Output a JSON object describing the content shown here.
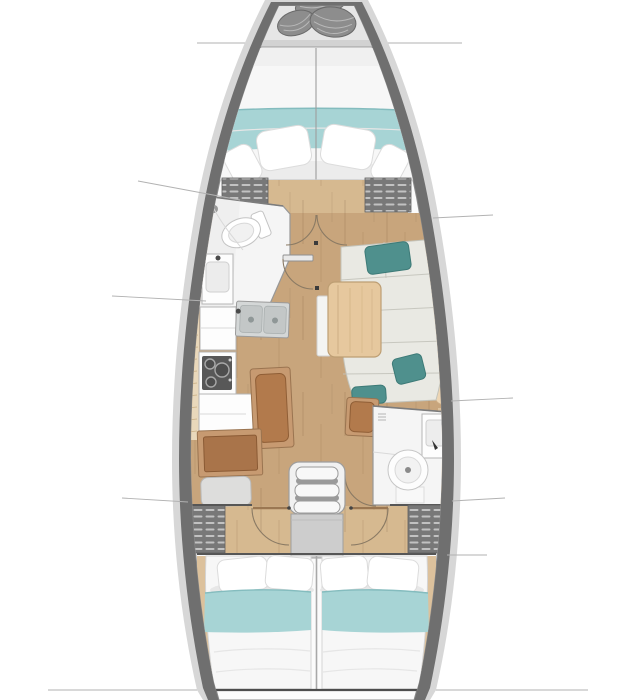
{
  "diagram": {
    "type": "sailboat-interior-floor-plan",
    "view": "top-down",
    "label": "Sailboat interior layout floor plan, bow at top",
    "rooms": [
      "anchor-locker",
      "forward-cabin",
      "forward-head",
      "galley",
      "salon",
      "nav-station",
      "aft-head",
      "companionway",
      "aft-cabin-port",
      "aft-cabin-starboard"
    ]
  },
  "colors": {
    "background": "#ffffff",
    "hull_rim": "#d7d7d7",
    "hull_wall": "#6f6f6f",
    "interior": "#fbfbfb",
    "locker_bay": "#e6e6e6",
    "rope": "#8d8d8d",
    "rope_edge": "#6a6a6a",
    "deck_band": "#d2d2d2",
    "bed": "#f7f7f7",
    "bed_edge": "#c9c9c9",
    "blanket": "#a7d4d5",
    "blanket_edge": "#84bcbe",
    "pillow": "#ffffff",
    "pillow_edge": "#dcdcdc",
    "shadow": "#e7e7e7",
    "wall": "#565656",
    "slat_dark": "#787878",
    "slat_light": "#c2c2c2",
    "floor": "#c8a57c",
    "floor_light": "#d6b990",
    "grain": "#8a6a48",
    "head_white": "#f5f5f5",
    "head_edge": "#989898",
    "porcelain": "#ffffff",
    "fixture_edge": "#c4c4c4",
    "counter": "#fdfdfd",
    "counter_edge": "#b5b5b5",
    "steel": "#d4d7d7",
    "steel_deep": "#c3c7c7",
    "stove_dark": "#585858",
    "burner": "#a8a8a8",
    "sofa": "#e9e9e3",
    "sofa_seam": "#c3c3ba",
    "back_cushion": "#edd5b3",
    "back_edge": "#ccab84",
    "teal": "#4f908d",
    "teal_edge": "#3d7a77",
    "table": "#e6c89e",
    "table_edge": "#bd9e73",
    "leaf": "#f4f4f2",
    "wood_frame": "#c79a71",
    "wood_frame_edge": "#9a7450",
    "seat_brown": "#b27a4c",
    "seat_brown_edge": "#8f5e36",
    "desk_top": "#a9744a",
    "cushion_gray": "#dddddc",
    "stairs": "#f1f1f1",
    "stair_edge": "#9e9e9e",
    "stair_shadow": "#8b8b8b",
    "engine": "#cdcdcd",
    "door_arc": "#8a7a64",
    "door_leaf": "#9b7752",
    "stop_mark": "#3b3b3b",
    "hairline": "#b2b2b2",
    "shelf_wood": "#e9d8bb",
    "shelf_tick": "#c9ae83",
    "side_strip": "#dcc19c",
    "transom": "#4d4d4d"
  }
}
